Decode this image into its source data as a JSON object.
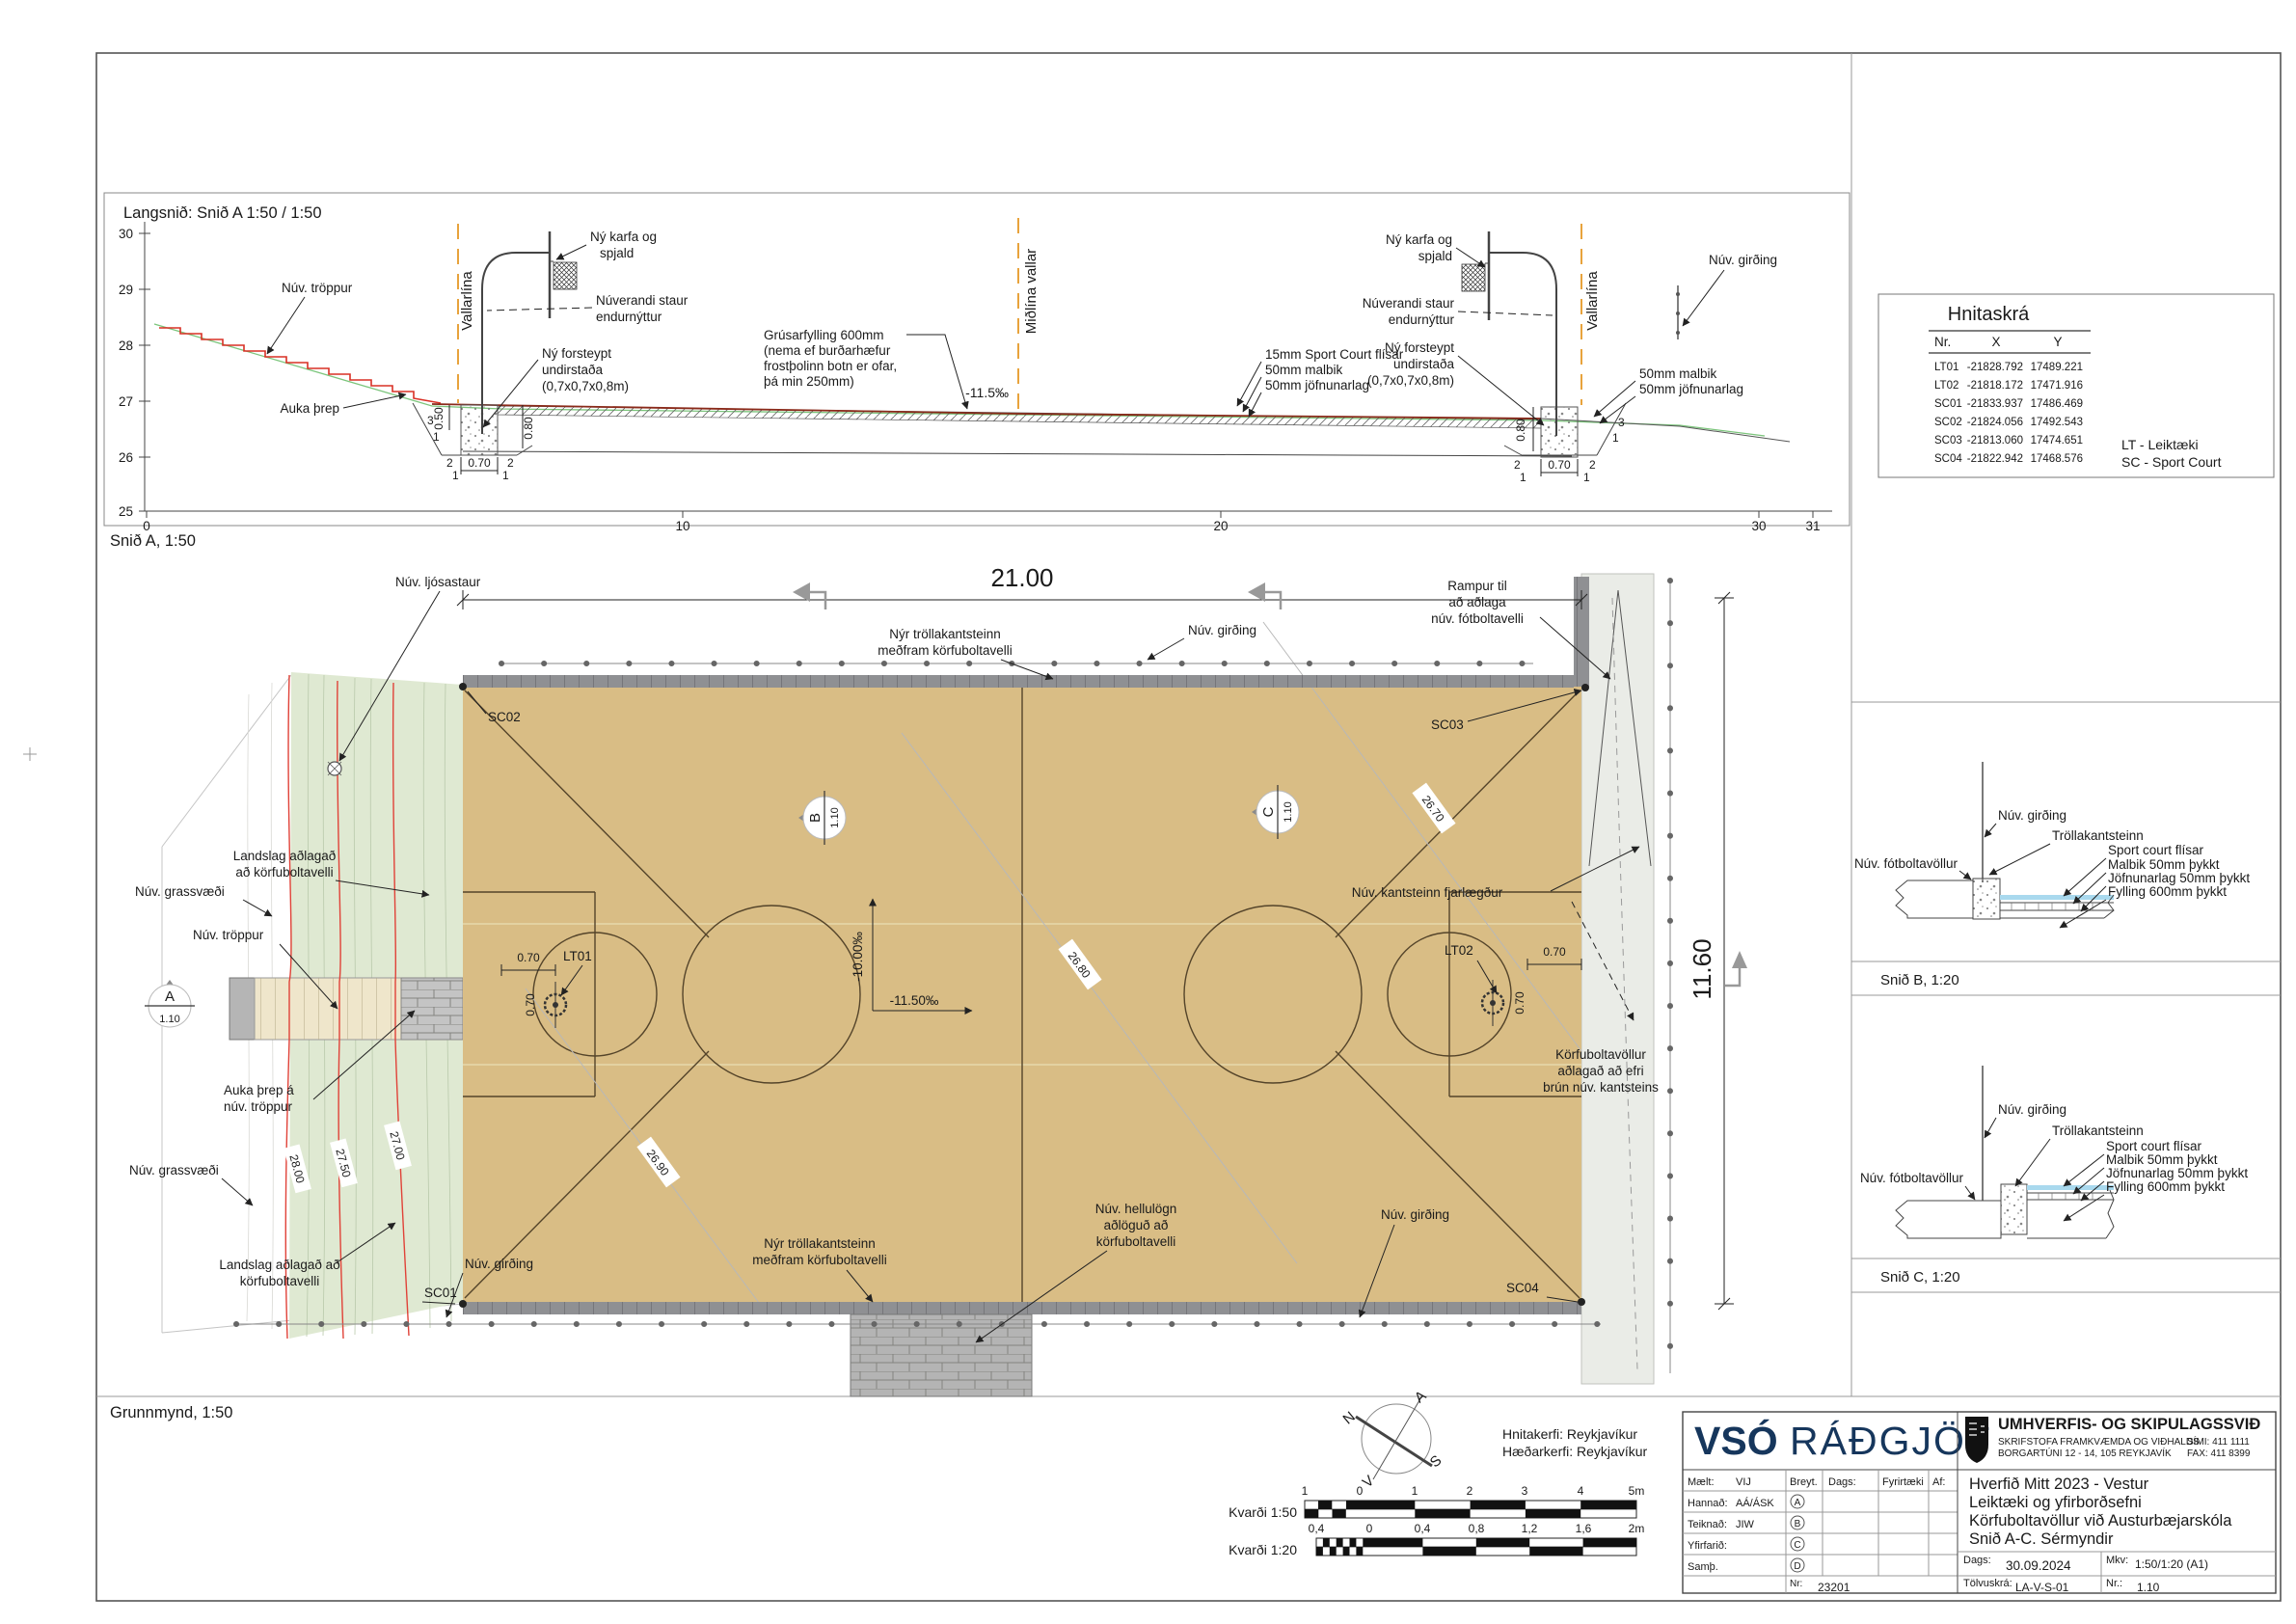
{
  "section": {
    "title": "Langsnið: Snið A 1:50 / 1:50",
    "caption": "Snið A, 1:50",
    "y_ticks": [
      "30",
      "29",
      "28",
      "27",
      "26",
      "25"
    ],
    "x_ticks": [
      "0",
      "10",
      "20",
      "30",
      "31"
    ],
    "nuv_troppur": "Núv. tröppur",
    "auka_threp": "Auka þrep",
    "vallarlina": "Vallarlína",
    "midlina": "Miðlína vallar",
    "karfa1": "Ný karfa og",
    "karfa2": "spjald",
    "staur1": "Núverandi staur",
    "staur2": "endurnýttur",
    "und1": "Ný forsteypt",
    "und2": "undirstaða",
    "und3": "(0,7x0,7x0,8m)",
    "grus1": "Grúsarfylling 600mm",
    "grus2": "(nema ef burðarhæfur",
    "grus3": "frostþolinn botn er ofar,",
    "grus4": "þá min 250mm)",
    "slope": "-11.5‰",
    "l15": "15mm Sport Court flísar",
    "l50m": "50mm malbik",
    "l50j": "50mm jöfnunarlag",
    "girding": "Núv. girðing",
    "d050": "0.50",
    "d070": "0.70",
    "d080": "0.80",
    "s3": "3",
    "s2": "2",
    "s1": "1"
  },
  "plan": {
    "caption": "Grunnmynd, 1:50",
    "dim_w": "21.00",
    "dim_h": "11.60",
    "ljosastaur": "Núv. ljósastaur",
    "troll1": "Nýr tröllakantsteinn",
    "troll2": "meðfram körfuboltavelli",
    "girding": "Núv. girðing",
    "rampur1": "Rampur til",
    "rampur2": "að aðlaga",
    "rampur3": "núv. fótboltavelli",
    "sc01": "SC01",
    "sc02": "SC02",
    "sc03": "SC03",
    "sc04": "SC04",
    "lt01": "LT01",
    "lt02": "LT02",
    "landslag1": "Landslag aðlagað",
    "landslag2": "að körfuboltavelli",
    "landslagb1": "Landslag aðlagað að",
    "landslagb2": "körfuboltavelli",
    "grassvaedi": "Núv. grassvæði",
    "troppur": "Núv. tröppur",
    "auka1": "Auka þrep á",
    "auka2": "núv. tröppur",
    "ma": "A",
    "mb": "B",
    "mc": "C",
    "mscale": "1.10",
    "kantsteinn": "Núv. kantsteinn fjarlægður",
    "slope_v": "-10.00‰",
    "slope_h": "-11.50‰",
    "c2800": "28.00",
    "c2750": "27.50",
    "c2700": "27.00",
    "c2690": "26.90",
    "c2680": "26.80",
    "c2670": "26.70",
    "korfu1": "Körfuboltavöllur",
    "korfu2": "aðlagað að efri",
    "korfu3": "brún núv. kantsteins",
    "hellu1": "Núv. hellulögn",
    "hellu2": "aðlöguð að",
    "hellu3": "körfuboltavelli",
    "d070": "0.70"
  },
  "hnitaskra": {
    "title": "Hnitaskrá",
    "headers": [
      "Nr.",
      "X",
      "Y"
    ],
    "rows": [
      [
        "LT01",
        "-21828.792",
        "17489.221"
      ],
      [
        "LT02",
        "-21818.172",
        "17471.916"
      ],
      [
        "SC01",
        "-21833.937",
        "17486.469"
      ],
      [
        "SC02",
        "-21824.056",
        "17492.543"
      ],
      [
        "SC03",
        "-21813.060",
        "17474.651"
      ],
      [
        "SC04",
        "-21822.942",
        "17468.576"
      ]
    ],
    "legend_lt": "LT - Leiktæki",
    "legend_sc": "SC - Sport Court"
  },
  "details": {
    "caption_b": "Snið B, 1:20",
    "caption_c": "Snið C, 1:20",
    "girding": "Núv. girðing",
    "kantsteinn": "Tröllakantsteinn",
    "l1": "Sport court flísar",
    "l2": "Malbik 50mm þykkt",
    "l3": "Jöfnunarlag 50mm þykkt",
    "l4": "Fylling 600mm þykkt",
    "fotbolta": "Núv. fótboltavöllur"
  },
  "footer": {
    "hnitakerfi": "Hnitakerfi: Reykjavíkur",
    "haedarkerfi": "Hæðarkerfi: Reykjavíkur",
    "compass": [
      "N",
      "A",
      "S",
      "V"
    ],
    "kv50": "Kvarði 1:50",
    "kv20": "Kvarði 1:20",
    "s50": [
      "1",
      "0",
      "1",
      "2",
      "3",
      "4",
      "5m"
    ],
    "s20": [
      "0,4",
      "0",
      "0,4",
      "0,8",
      "1,2",
      "1,6",
      "2m"
    ]
  },
  "titleblock": {
    "vso": "VSÓ",
    "radgjof": "RÁÐGJÖF",
    "dept": "UMHVERFIS- OG SKIPULAGSSVIÐ",
    "office": "SKRIFSTOFA FRAMKVÆMDA OG VIÐHALDS",
    "address": "BORGARTÚNI 12 - 14, 105 REYKJAVÍK",
    "phone": "SÍMI: 411 1111",
    "fax": "FAX: 411 8399",
    "rows": [
      [
        "Mælt:",
        "VIJ"
      ],
      [
        "Hannað:",
        "AÁ/ÁSK"
      ],
      [
        "Teiknað:",
        "JIW"
      ],
      [
        "Yfirfarið:",
        ""
      ],
      [
        "Samþ.",
        ""
      ]
    ],
    "rev": [
      "A",
      "B",
      "C",
      "D"
    ],
    "cols": [
      "Breyt.",
      "Dags:",
      "Fyrirtæki",
      "Af:"
    ],
    "nr_label": "Nr:",
    "nr": "23201",
    "project": [
      "Hverfið Mitt 2023 - Vestur",
      "Leiktæki og yfirborðsefni",
      "Körfuboltavöllur við Austurbæjarskóla",
      "Snið A-C. Sérmyndir"
    ],
    "dags_label": "Dags:",
    "dags": "30.09.2024",
    "mkv_label": "Mkv:",
    "mkv": "1:50/1:20 (A1)",
    "tolvu_label": "Tölvuskrá:",
    "tolvu": "LA-V-S-01",
    "nr2_label": "Nr.:",
    "nr2": "1.10"
  }
}
